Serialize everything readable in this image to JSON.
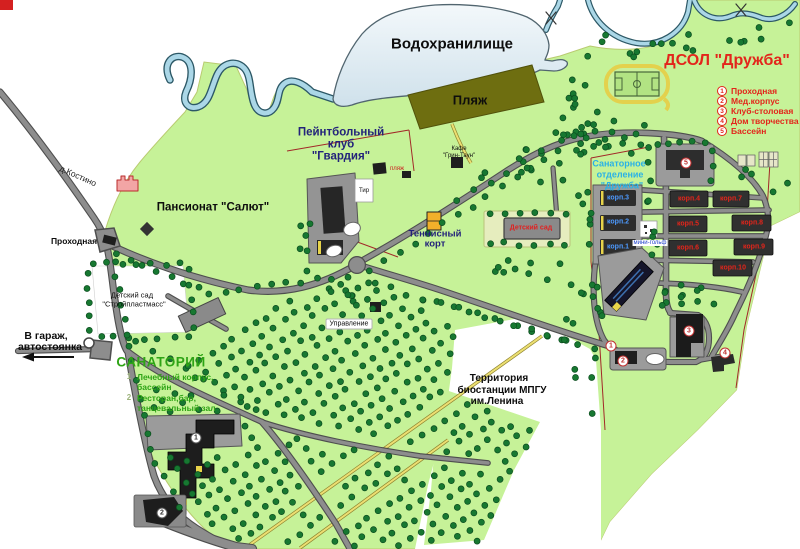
{
  "map": {
    "water_label": "Водохранилище",
    "beach_label": "Пляж",
    "colors": {
      "land": "#c6f298",
      "water": "#dfeaf2",
      "beach": "#6e6e10",
      "road": "#8d8d8d",
      "tree": "#177831",
      "dsol_text": "#e3251b",
      "sanatoriy_text": "#2ea415",
      "dept_text": "#29b1e6",
      "navy_text": "#23237a"
    },
    "dsol": {
      "title": "ДСОЛ  \"Дружба\"",
      "legend": [
        {
          "num": "1",
          "label": "Проходная"
        },
        {
          "num": "2",
          "label": "Мед.корпус"
        },
        {
          "num": "3",
          "label": "Клуб-столовая"
        },
        {
          "num": "4",
          "label": "Дом творчества"
        },
        {
          "num": "5",
          "label": "Бассейн"
        }
      ],
      "korpus": [
        "корп.1",
        "корп.2",
        "корп.3",
        "корп.4",
        "корп.5",
        "корп.6",
        "корп.7",
        "корп.8",
        "корп.9",
        "корп.10"
      ],
      "sanatorium_dept_lines": [
        "Санаторное",
        "отделение",
        "\"Дружба\""
      ],
      "kindergarten_label": "Детский сад",
      "minigolf_label": "мини-гольф"
    },
    "paintball_lines": [
      "Пейнтбольный",
      "клуб",
      "\"Гвардия\""
    ],
    "pansionat_label": "Пансионат \"Салют\"",
    "village_road_label": "д.Костино",
    "checkpoint_label": "Проходная",
    "kindergarten2_lines": [
      "Детский сад",
      "\"Стройпластмасс\""
    ],
    "garage_lines": [
      "В гараж,",
      "автостоянка"
    ],
    "sanatoriy": {
      "title": "САНАТОРИЙ",
      "legend": [
        {
          "num": "1",
          "lines": [
            "Лечебный корпус,",
            "бассейн"
          ]
        },
        {
          "num": "2",
          "lines": [
            "Ресторан,бар,",
            "танцевальный зал"
          ]
        }
      ]
    },
    "tennis_lines": [
      "Теннисный",
      "корт"
    ],
    "administration_label": "Управление",
    "biostation_lines": [
      "Территория",
      "биостанции МПГУ",
      "им.Ленина"
    ],
    "cafe_lines": [
      "Кафе",
      "\"Грин-Таун\""
    ],
    "shooting_range_label": "Тир",
    "beach_sign_label": "пляж"
  }
}
